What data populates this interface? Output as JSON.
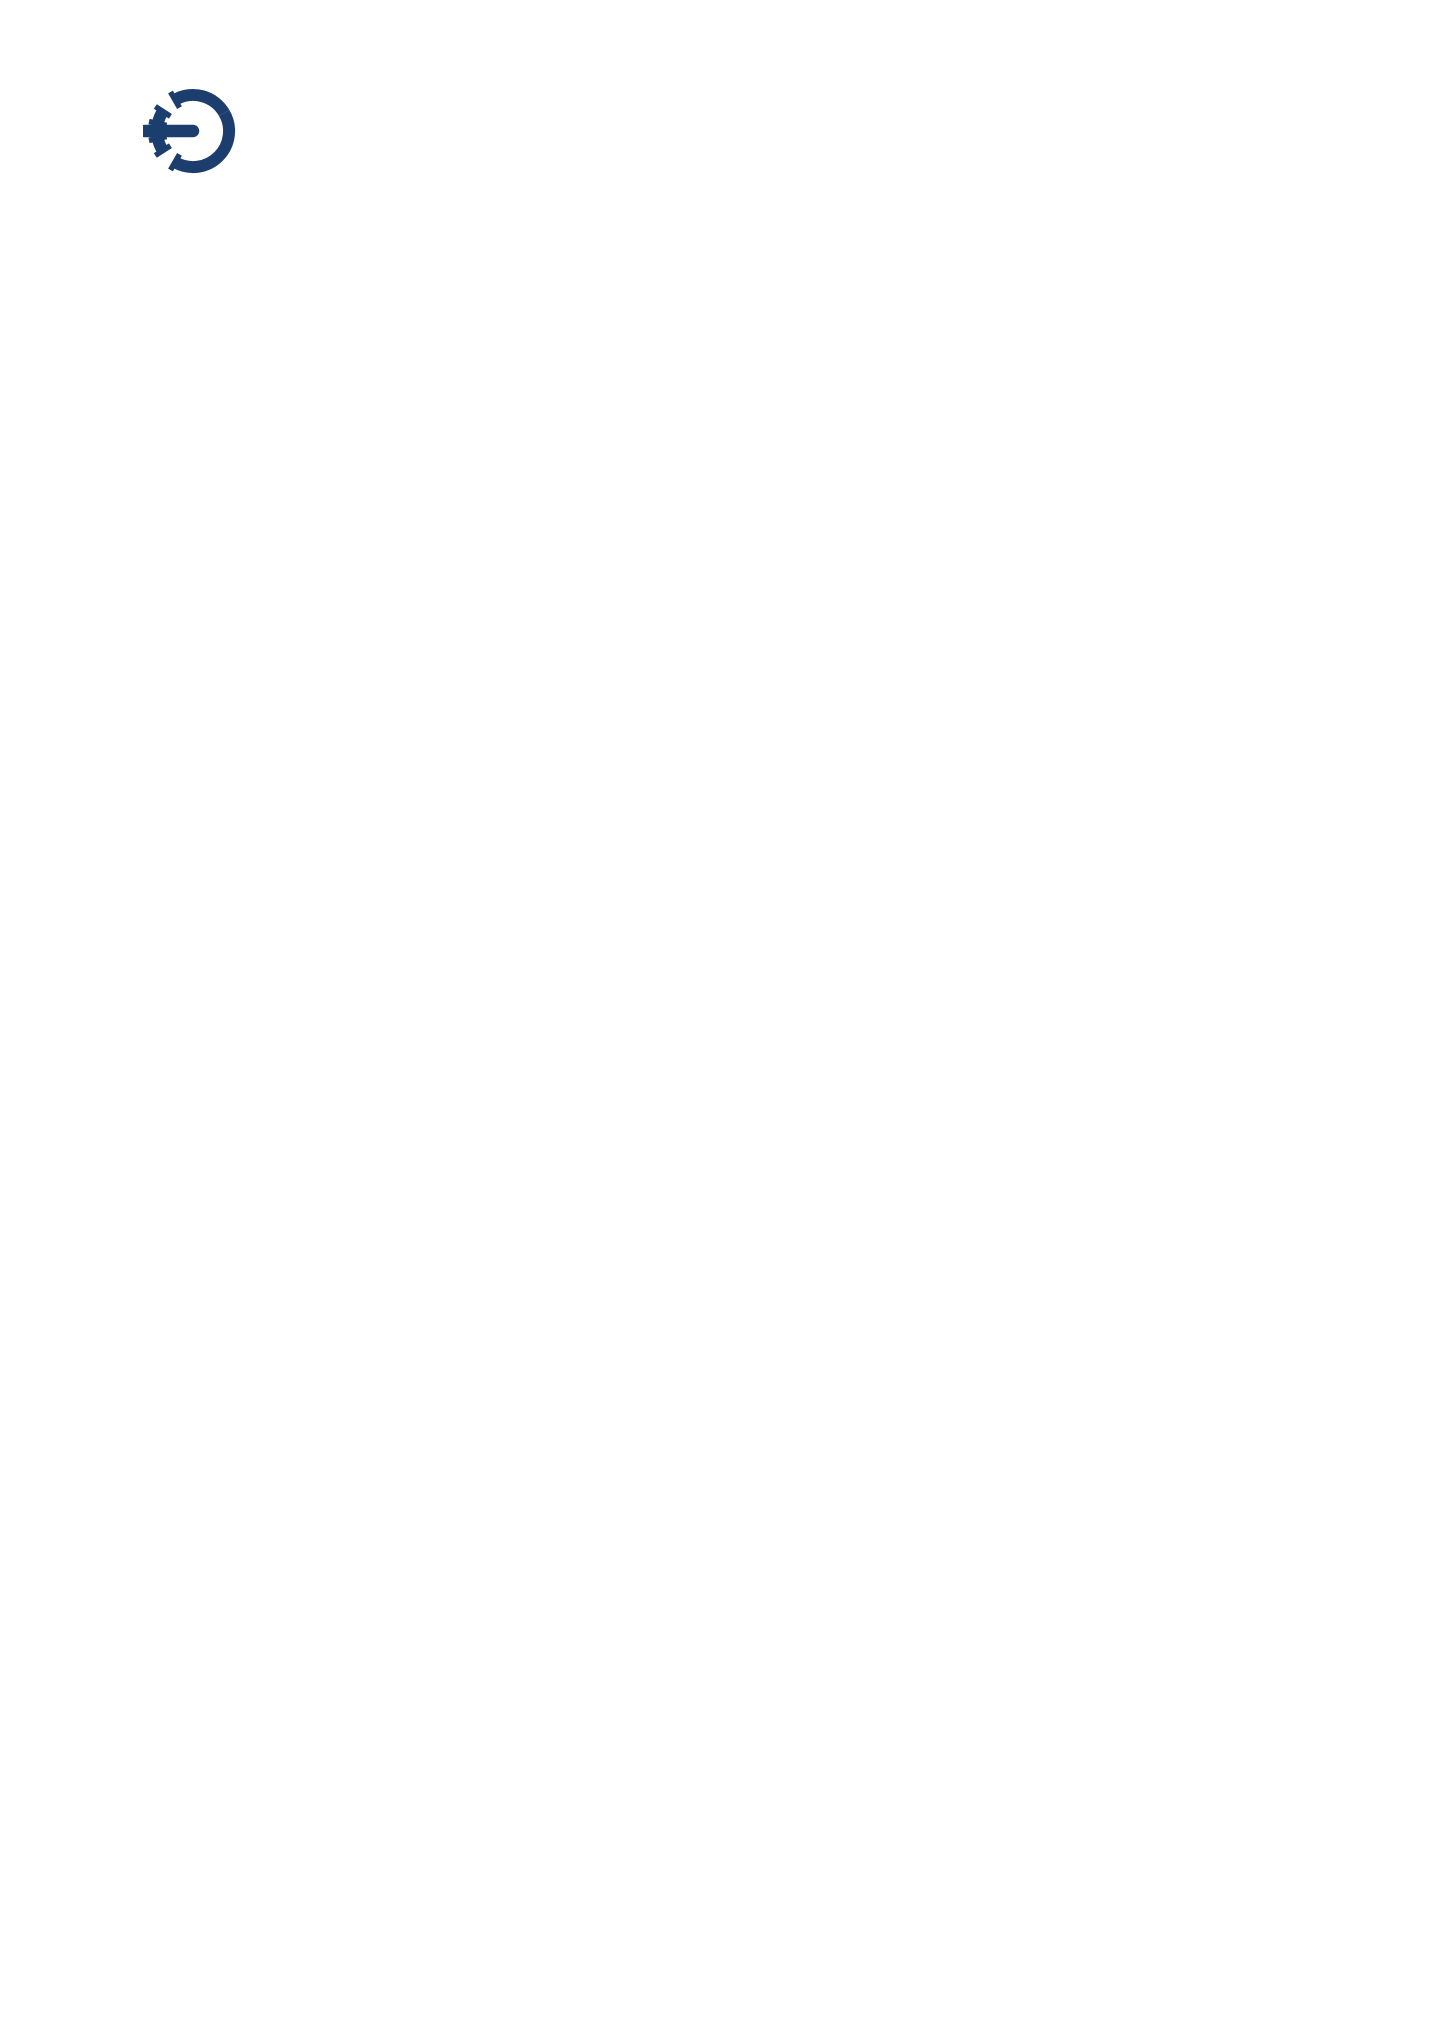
{
  "header": {
    "logo_text": "OGE",
    "address": {
      "line1": "Open Grid Europe GmbH",
      "line2": "Wardenburg field site (NETRA compressor station)",
      "line3": "Depenstroh 49",
      "line4": "26203 Wardenburg",
      "line5": "T +49 201 3642-61131"
    }
  },
  "map": {
    "frame": {
      "x": 152,
      "y": 207,
      "w": 1158,
      "h": 1151
    },
    "colors": {
      "bg": "#c6e7f6",
      "road": "#74c6b6",
      "area": "#99d3c6",
      "label": "#394750",
      "label_dark": "#2e3a43",
      "arrow_blue": "#1d4e86",
      "arrow_dark": "#333a42",
      "badge_text": "#53bfae",
      "box_text": "#1d4e89",
      "dot": "#123a68",
      "north": "#3a4148"
    },
    "areas": [
      {
        "points": "255,250 332,266 318,346 240,327"
      },
      {
        "points": "298,396 420,460 372,502 285,470"
      },
      {
        "points": "152,851 226,842 233,899 158,906"
      },
      {
        "points": "808,610 846,615 843,662 805,657"
      },
      {
        "points": "1030,820 1062,820 1108,887 1076,890"
      },
      {
        "points": "893,862 940,880 930,925 890,910"
      },
      {
        "points": "575,690 746,706 810,725 848,772 882,825 900,870 903,905 865,938 800,1002 735,1068 700,1100 664,1040 630,960 610,880 600,790"
      }
    ],
    "roads": [
      {
        "d": "M883 207 L858 285 L826 372 L810 420",
        "w": 12
      },
      {
        "d": "M810 420 L783 478 L758 540 L744 610 L741 660 L746 712",
        "w": 12
      },
      {
        "d": "M535 207 L590 252 L623 277 L700 338 L768 392 L810 420",
        "w": 12
      },
      {
        "d": "M810 420 L872 466 L938 508 L1000 543 L1035 558 L1110 552 L1190 523 L1255 492 L1310 468",
        "w": 12
      },
      {
        "d": "M623 277 L540 335 L447 400 L390 448 L347 497",
        "w": 9
      },
      {
        "d": "M347 497 L255 531 L152 549",
        "w": 9
      },
      {
        "d": "M152 342 L220 398 L290 452 L347 497",
        "w": 9
      },
      {
        "d": "M347 497 L357 562 L346 610 L334 636",
        "w": 8
      },
      {
        "d": "M152 597 L250 615 L420 650 L560 672 L680 700 L746 712",
        "w": 12
      },
      {
        "d": "M746 712 L830 714 L900 711 L928 723",
        "w": 10
      },
      {
        "d": "M1037 553 L1000 610 L960 672 L928 723",
        "w": 9
      },
      {
        "d": "M928 723 L950 770 L945 825 L925 870 L905 898",
        "w": 10
      },
      {
        "d": "M746 712 L792 748 L845 802 L885 856 L908 897",
        "w": 12
      },
      {
        "d": "M1310 896 L1150 893 L1020 897 L908 897",
        "w": 12
      },
      {
        "d": "M908 897 L860 932 L800 995 L740 1053 L700 1092 L676 1140 L665 1210 L661 1290 L660 1358",
        "w": 12
      },
      {
        "d": "M152 1042 L240 970 L330 900 L398 873",
        "w": 9
      },
      {
        "d": "M398 873 L470 800 L540 735 L580 710",
        "w": 9
      },
      {
        "d": "M398 873 L470 920 L545 968 L610 1018 L668 1080",
        "w": 9
      },
      {
        "d": "M152 1192 L270 1160 L400 1125 L530 1095 L640 1080 L700 1092",
        "w": 9
      },
      {
        "d": "M905 898 L922 958 L942 1042 L974 1126 L1016 1196 L1070 1265 L1120 1330 L1140 1358",
        "w": 9
      },
      {
        "d": "M790 1358 L860 1300 L940 1232 L1012 1172 L1040 1148",
        "w": 9
      },
      {
        "d": "M952 1278 L1040 1160 L1120 1072 L1195 995 L1245 950",
        "w": 9
      },
      {
        "d": "M1243 555 L1234 660 L1227 780 L1226 860 L1228 897 L1238 940 L1268 975 L1300 998 L1310 1003",
        "w": 9
      },
      {
        "d": "M1250 940 L1200 1055 L1160 1150 L1133 1240 L1124 1310 L1122 1358",
        "w": 9
      },
      {
        "d": "M1160 1150 L1240 1118 L1310 1096",
        "w": 9
      },
      {
        "d": "M1133 207 L1180 300 L1220 400 L1240 480 L1243 555",
        "w": 9
      },
      {
        "d": "M385 207 L300 290 L215 355 L152 398",
        "w": 9
      },
      {
        "d": "M800 1066 L868 1046 L932 1020",
        "w": 8
      },
      {
        "d": "M1055 700 L1065 760 L1070 820 L1073 897 L1080 985 L1108 1042",
        "w": 8
      },
      {
        "d": "M846 958 L874 988",
        "w": 8
      }
    ],
    "labels": [
      {
        "id": "tungeln",
        "text": "Tungeln",
        "x": 848,
        "y": 234,
        "rot": 0,
        "fs": 18,
        "fw": 700,
        "dark": true
      },
      {
        "id": "ziegeleiweg",
        "text": "Ziegeleiweg",
        "x": 520,
        "y": 323,
        "rot": -33,
        "fs": 15
      },
      {
        "id": "fuerstendamm",
        "text": "Fürstendamm",
        "x": 753,
        "y": 336,
        "rot": 50,
        "fs": 15
      },
      {
        "id": "depenstroh",
        "text": "Depenstroh",
        "x": 893,
        "y": 519,
        "rot": 41,
        "fs": 15
      },
      {
        "id": "westerholt",
        "text": "Westerholt",
        "x": 229,
        "y": 560,
        "rot": 0,
        "fs": 17,
        "fw": 700,
        "dark": true
      },
      {
        "id": "ammerlaender-strasse",
        "text": "Ammerländer Straße",
        "x": 430,
        "y": 634,
        "rot": 10,
        "fs": 15
      },
      {
        "id": "tungeler-damm",
        "text": "Tungeler Damm",
        "x": 786,
        "y": 607,
        "rot": -80,
        "fs": 15
      },
      {
        "id": "herbergen",
        "text": "Herbergen",
        "x": 870,
        "y": 691,
        "rot": 0,
        "fs": 15
      },
      {
        "id": "lethestr",
        "text": "Lethestr.",
        "x": 971,
        "y": 679,
        "rot": -55,
        "fs": 15
      },
      {
        "id": "am-brink",
        "text": "Am Brink",
        "x": 794,
        "y": 773,
        "rot": 48,
        "fs": 15
      },
      {
        "id": "oberlethe",
        "text": "Oberlethe",
        "x": 790,
        "y": 880,
        "rot": 0,
        "fs": 21
      },
      {
        "id": "wardenburger-str-east",
        "text": "Wardenburger Str.",
        "x": 1044,
        "y": 869,
        "rot": -7,
        "fs": 15
      },
      {
        "id": "friedrichstrasse",
        "text": "Friedrichstraße",
        "x": 1209,
        "y": 927,
        "rot": -4,
        "fs": 15
      },
      {
        "id": "poggenpohlweg",
        "text": "Poggenpohlweg",
        "x": 1240,
        "y": 800,
        "rot": 90,
        "fs": 15
      },
      {
        "id": "a29",
        "text": "A 29",
        "x": 1267,
        "y": 1031,
        "rot": 0,
        "fs": 18,
        "fw": 700,
        "dark": true
      },
      {
        "id": "as18",
        "text": "AS 18",
        "x": 1266,
        "y": 1057,
        "rot": 0,
        "fs": 18,
        "fw": 700,
        "dark": true
      },
      {
        "id": "am-speckkamp",
        "text": "Am Speckkamp",
        "x": 289,
        "y": 934,
        "rot": -40,
        "fs": 15
      },
      {
        "id": "sommerweg",
        "text": "Sommerweg",
        "x": 521,
        "y": 903,
        "rot": 52,
        "fs": 15
      },
      {
        "id": "ollenkamp",
        "text": "Ollenkamp",
        "x": 547,
        "y": 969,
        "rot": 38,
        "fs": 15
      },
      {
        "id": "zum-fuhrenkamp",
        "text": "Zum Fuhrenkamp",
        "x": 484,
        "y": 1114,
        "rot": -9,
        "fs": 15
      },
      {
        "id": "achternholt",
        "text": "Achternholt",
        "x": 581,
        "y": 1330,
        "rot": 0,
        "fs": 18,
        "fw": 700,
        "dark": true
      },
      {
        "id": "wardenburger-str-diag",
        "text": "Wardenburger Str.",
        "x": 797,
        "y": 992,
        "rot": -52,
        "fs": 15
      },
      {
        "id": "baumweg",
        "text": "Baumweg",
        "x": 869,
        "y": 1021,
        "rot": -13,
        "fs": 15
      },
      {
        "id": "zum-hoog",
        "text": "Zum Hoog",
        "x": 884,
        "y": 1071,
        "rot": -2,
        "fs": 15
      },
      {
        "id": "kirchweg-upper",
        "text": "Kirchweg",
        "x": 999,
        "y": 1078,
        "rot": -75,
        "fs": 15
      },
      {
        "id": "am-busch",
        "text": "Am Busch",
        "x": 1066,
        "y": 1112,
        "rot": -35,
        "fs": 15
      },
      {
        "id": "am-rosengarten",
        "text": "Am Rosengarten",
        "x": 1157,
        "y": 1240,
        "rot": -55,
        "fs": 15
      },
      {
        "id": "kirchweg-lower",
        "text": "Kirchweg",
        "x": 873,
        "y": 1265,
        "rot": -44,
        "fs": 15
      },
      {
        "id": "north-n",
        "text": "N",
        "x": 1196,
        "y": 352,
        "rot": 0,
        "fs": 26,
        "fw": 700,
        "dark": true
      }
    ],
    "badges": [
      {
        "id": "k149-upper",
        "text": "K 149",
        "x": 789,
        "y": 501
      },
      {
        "id": "k141",
        "text": "K 141",
        "x": 551,
        "y": 676
      },
      {
        "id": "k149-lower",
        "text": "K 149",
        "x": 856,
        "y": 840
      },
      {
        "id": "k292",
        "text": "K 292",
        "x": 992,
        "y": 898
      }
    ],
    "arrows": [
      {
        "id": "tungeln-arrow",
        "x": 781,
        "y": 233,
        "rot": 0,
        "c": "dark"
      },
      {
        "id": "route-arrow-1",
        "x": 790,
        "y": 445,
        "rot": -10,
        "c": "blue"
      },
      {
        "id": "route-arrow-2",
        "x": 852,
        "y": 437,
        "rot": 135,
        "c": "blue"
      },
      {
        "id": "route-arrow-3",
        "x": 723,
        "y": 500,
        "rot": -8,
        "c": "blue"
      },
      {
        "id": "route-arrow-4",
        "x": 743,
        "y": 658,
        "rot": 0,
        "c": "blue"
      },
      {
        "id": "route-arrow-5",
        "x": 768,
        "y": 700,
        "rot": -95,
        "c": "blue"
      },
      {
        "id": "route-arrow-6",
        "x": 839,
        "y": 755,
        "rot": -40,
        "c": "blue"
      },
      {
        "id": "route-arrow-7",
        "x": 907,
        "y": 868,
        "rot": -40,
        "c": "blue"
      },
      {
        "id": "route-arrow-8",
        "x": 1147,
        "y": 892,
        "rot": -90,
        "c": "blue"
      },
      {
        "id": "route-arrow-9",
        "x": 1268,
        "y": 894,
        "rot": -90,
        "c": "blue"
      },
      {
        "id": "a29-arrow",
        "x": 1270,
        "y": 1001,
        "rot": 90,
        "c": "dark"
      },
      {
        "id": "westerholt-arrow",
        "x": 172,
        "y": 591,
        "rot": -90,
        "c": "dark"
      },
      {
        "id": "achternholt-arrow",
        "x": 497,
        "y": 1329,
        "rot": 180,
        "c": "dark"
      }
    ],
    "north": {
      "x": 1170,
      "tip": 238,
      "base": 290,
      "bottom": 455
    },
    "site_box": {
      "line1": "OGE Wardenburg",
      "line2": "field site"
    },
    "site_dot": {
      "x": 834,
      "y": 468,
      "r": 11
    }
  },
  "directions": {
    "title": "Coming on the BAB 29 Cloppenburg - Oldenburg",
    "subtitle": "From the direction of Cloppenburg",
    "steps": [
      "On the BAB 29 take the exit marked Wardenburg (No. 18).",
      "Turn left in the direction of Wardenburg onto the K 242.",
      "Turn right onto Oldenburger Strasse (L 870) and follow the road for approx. 3 km.",
      "Turn left onto Friedrichstrasse (K 292) and follow the road.",
      "Continue straight on onto Wardenburger Strasse (K 292).",
      "Turn right onto Am Brink (K 149).",
      "After approx. 400 m turn right onto Tungeler Damm (K 149).",
      "After approx. 600 m turn right onto Depenstroh where you will see the field site",
      "(NETRA compressor station)."
    ]
  },
  "footer_note": "Date of issue June 2020"
}
